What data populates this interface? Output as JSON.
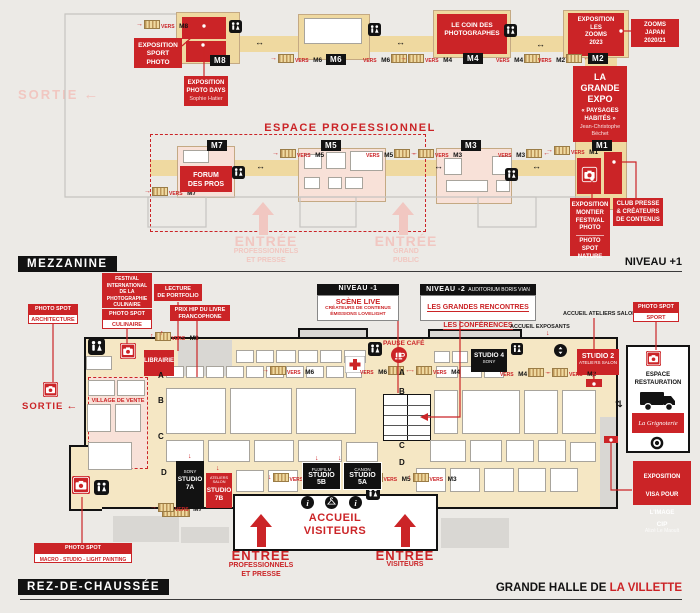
{
  "palette": {
    "red": "#CB2427",
    "tan": "#EFD9A0",
    "hall": "#F5E7C4",
    "pink": "#F8E1D8",
    "pale_pink": "#F1C7C1",
    "black": "#121212"
  },
  "glyphs": {
    "left": "←",
    "right": "→",
    "up": "↑",
    "down": "↓",
    "lr": "↔",
    "updown": "⇅"
  },
  "mezzanine": {
    "band": "MEZZANINE",
    "level": "NIVEAU +1",
    "sortie": "SORTIE",
    "chips": {
      "m1": "M1",
      "m2": "M2",
      "m3": "M3",
      "m4": "M4",
      "m5": "M5",
      "m6": "M6",
      "m7": "M7",
      "m8": "M8"
    },
    "vers": "VERS",
    "espace_pro": "ESPACE PROFESSIONNEL",
    "forum": "FORUM\nDES PROS",
    "expo_sport": "EXPOSITION\nSPORT\nPHOTO",
    "photo_days": "EXPOSITION\nPHOTO DAYS",
    "photo_days_sub": "Sophie Hatier",
    "coin": "LE COIN DES\nPHOTOGRAPHES",
    "zooms": "EXPOSITION\nLES\nZOOMS\n2023",
    "zooms_japan": "ZOOMS\nJAPAN\n2020/21",
    "grande_expo": "LA\nGRANDE\nEXPO",
    "grande_expo_sub": "« PAYSAGES\nHABITÉS »",
    "grande_expo_author": "Jean-Christophe\nBéchet",
    "montier": "EXPOSITION\nMONTIER\nFESTIVAL\nPHOTO",
    "spot_nature": "PHOTO\nSPOT\nNATURE",
    "club_presse": "CLUB PRESSE\n& CRÉATEURS\nDE CONTENUS",
    "entree": "ENTRÉE",
    "entree_pro_sub": "PROFESSIONNELS\nET PRESSE",
    "entree_public_sub": "GRAND\nPUBLIC"
  },
  "ground": {
    "band": "REZ-DE-CHAUSSÉE",
    "venue_black": "GRANDE HALLE DE",
    "venue_red": "LA VILLETTE",
    "sortie": "SORTIE",
    "photo_spot": "PHOTO SPOT",
    "culinaire_title": "FESTIVAL\nINTERNATIONAL\nDE LA\nPHOTOGRAPHIE\nCULINAIRE",
    "spot_culinaire": "CULINAIRE",
    "spot_architecture": "ARCHITECTURE",
    "spot_sport": "SPORT",
    "spot_macro": "MACRO - STUDIO - LIGHT PAINTING",
    "lecture": "LECTURE\nDE PORTFOLIO",
    "prix_hip": "PRIX HIP DU LIVRE\nFRANCOPHONE",
    "niveau1": "NIVEAU -1",
    "scene_live": "SCÈNE LIVE",
    "scene_live_sub": "CRÉATEURS DE CONTENUS\nÉMISSIONS LOVELIGHT",
    "niveau2": "NIVEAU -2",
    "auditorium": "AUDITORIUM BORIS VIAN",
    "rencontres": "LES GRANDES RENCONTRES",
    "conferences": "LES CONFÉRENCES",
    "accueil_exposants": "ACCUEIL EXPOSANTS",
    "accueil_ateliers": "ACCUEIL ATELIERS SALON",
    "librairie": "LIBRAIRIE",
    "village": "VILLAGE DE VENTE",
    "pause_cafe": "PAUSE CAFÉ",
    "studio2": "STUDIO 2",
    "studio2_sub": "ATELIERS SALON",
    "studio4": "STUDIO 4",
    "sony": "SONY",
    "fujifilm": "FUJIFILM",
    "canon": "CANON",
    "studio5b": "STUDIO 5B",
    "studio5a": "STUDIO 5A",
    "studio7a": "STUDIO\n7A",
    "studio7b": "STUDIO\n7B",
    "ateliers_salon": "ATELIERS SALON",
    "accueil_visiteurs": "ACCUEIL\nVISITEURS",
    "restauration": "ESPACE\nRESTAURATION",
    "grignoterie": "La Grignoterie",
    "visa": "EXPOSITION\nVISA POUR\nL'IMAGE",
    "cip": "CIP",
    "visa_author": "Alizé Le Maoult",
    "entree": "ENTRÉE",
    "entree_pro_sub": "PROFESSIONNELS\nET PRESSE",
    "entree_visiteurs_sub": "VISITEURS",
    "rows": [
      "A",
      "B",
      "C",
      "D"
    ]
  }
}
